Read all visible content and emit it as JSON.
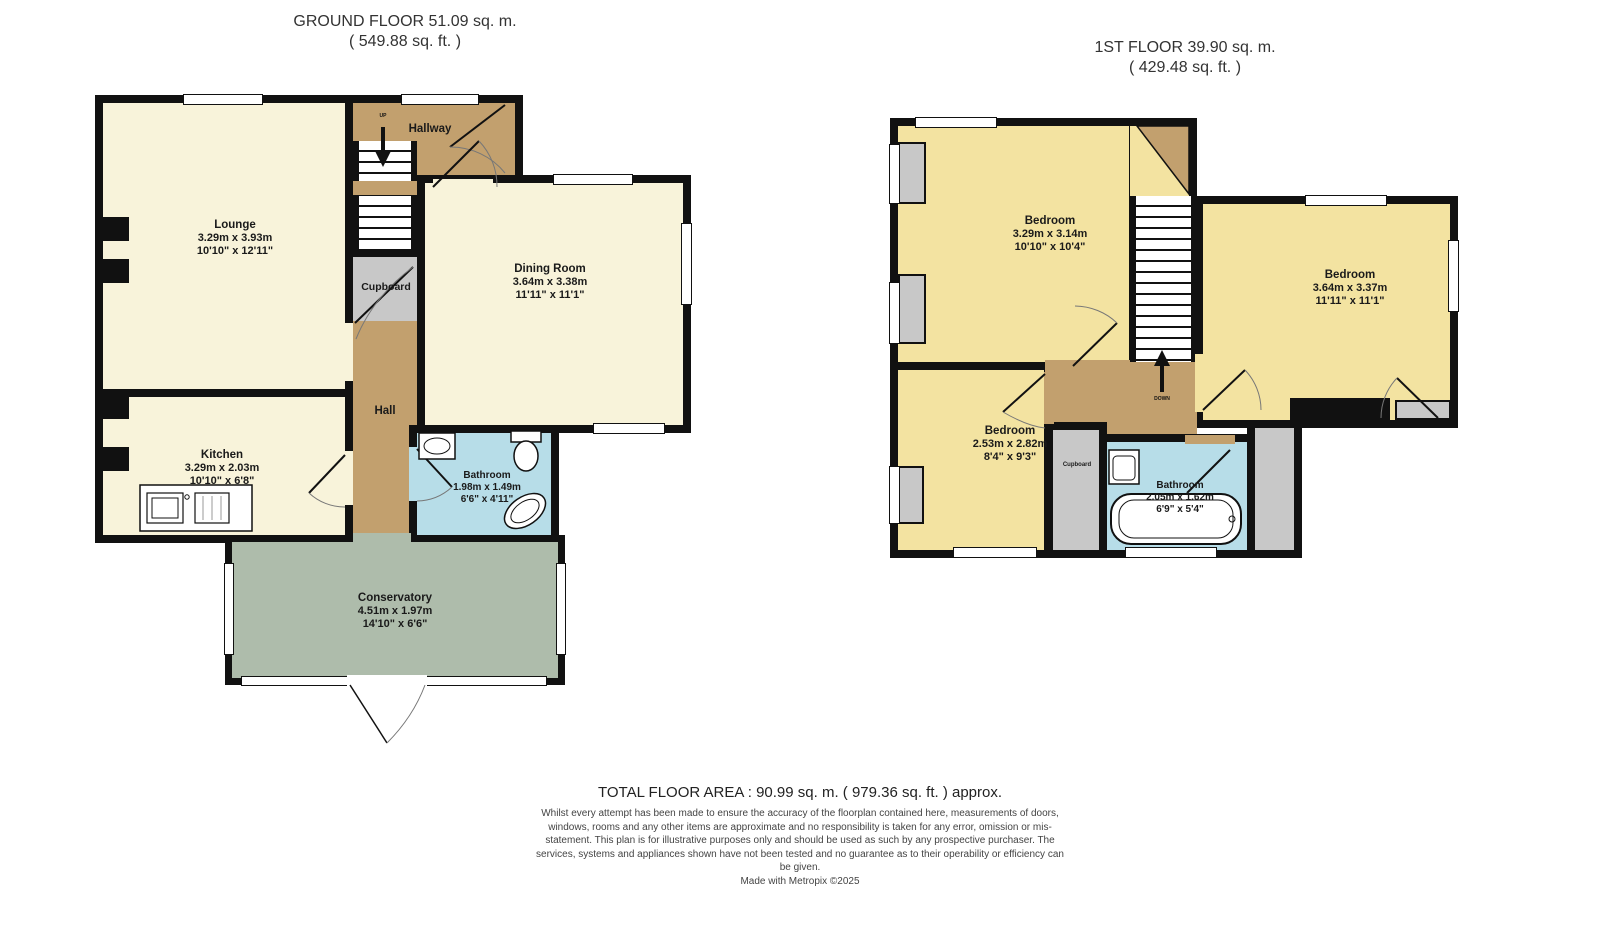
{
  "ground_floor": {
    "title": "GROUND FLOOR 51.09 sq. m.",
    "subtitle": "( 549.88 sq. ft. )",
    "stairs_label": "UP",
    "rooms": {
      "lounge": {
        "name": "Lounge",
        "metric": "3.29m x 3.93m",
        "imperial": "10'10\" x 12'11\""
      },
      "kitchen": {
        "name": "Kitchen",
        "metric": "3.29m x 2.03m",
        "imperial": "10'10\" x 6'8\""
      },
      "dining_room": {
        "name": "Dining Room",
        "metric": "3.64m x 3.38m",
        "imperial": "11'11\" x 11'1\""
      },
      "bathroom": {
        "name": "Bathroom",
        "metric": "1.98m x 1.49m",
        "imperial": "6'6\" x 4'11\""
      },
      "conservatory": {
        "name": "Conservatory",
        "metric": "4.51m x 1.97m",
        "imperial": "14'10\" x 6'6\""
      },
      "hallway": {
        "name": "Hallway"
      },
      "hall": {
        "name": "Hall"
      },
      "cupboard": {
        "name": "Cupboard"
      }
    }
  },
  "first_floor": {
    "title": "1ST FLOOR 39.90 sq. m.",
    "subtitle": "( 429.48 sq. ft. )",
    "stairs_label": "DOWN",
    "rooms": {
      "bedroom_1": {
        "name": "Bedroom",
        "metric": "3.29m x 3.14m",
        "imperial": "10'10\" x 10'4\""
      },
      "bedroom_2": {
        "name": "Bedroom",
        "metric": "3.64m x 3.37m",
        "imperial": "11'11\" x 11'1\""
      },
      "bedroom_3": {
        "name": "Bedroom",
        "metric": "2.53m x 2.82m",
        "imperial": "8'4\" x 9'3\""
      },
      "bathroom": {
        "name": "Bathroom",
        "metric": "2.05m x 1.62m",
        "imperial": "6'9\" x 5'4\""
      },
      "cupboard": {
        "name": "Cupboard"
      }
    }
  },
  "footer": {
    "total_area": "TOTAL FLOOR AREA : 90.99 sq. m. ( 979.36 sq. ft. ) approx.",
    "disclaimer": "Whilst every attempt has been made to ensure the accuracy of the floorplan contained here, measurements of doors, windows, rooms and any other items are approximate and no responsibility is taken for any error, omission or mis-statement. This plan is for illustrative purposes only and should be used as such by any prospective purchaser. The services, systems and appliances shown have not been tested and no guarantee as to their operability or efficiency can be given.",
    "credit": "Made with Metropix ©2025"
  },
  "colors": {
    "wall": "#111111",
    "room_cream": "#f8f3da",
    "bedroom_yellow": "#f3e3a1",
    "hall_tan": "#c2a06e",
    "bathroom_blue": "#b7dde8",
    "conservatory_green": "#aebcab",
    "cupboard_gray": "#c8c8c8"
  }
}
